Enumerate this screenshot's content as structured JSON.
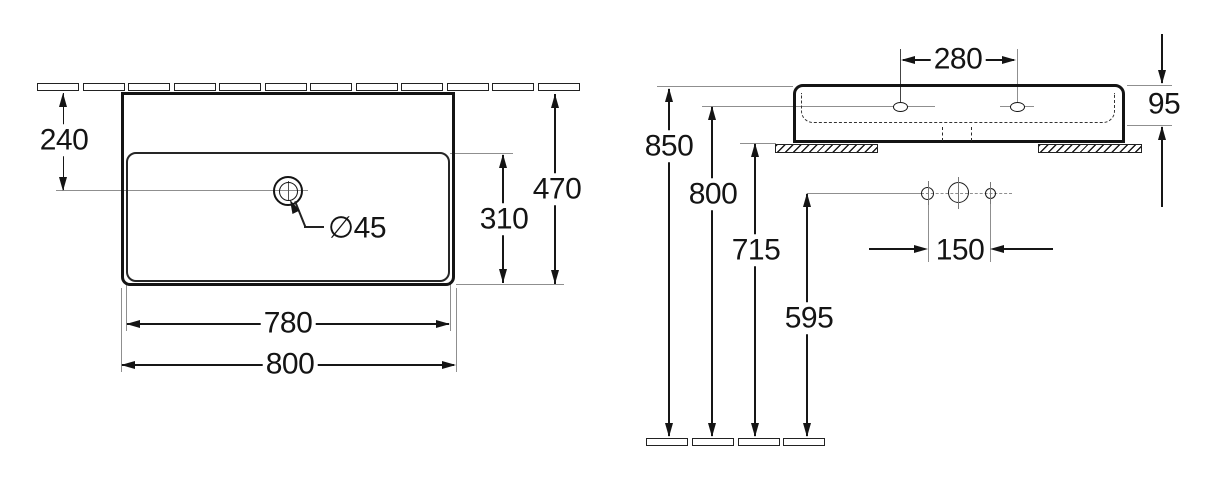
{
  "drawing_type": "washbasin installation dimensions, top view and side view",
  "left_view": {
    "dim_setback": "240",
    "dim_depth": "470",
    "dim_bowl_depth": "310",
    "dim_bowl_width": "780",
    "dim_width": "800",
    "dim_drain": "∅45"
  },
  "right_view": {
    "dim_tap_spacing": "280",
    "dim_body_height": "95",
    "dim_rim_height": "850",
    "dim_tap_height": "800",
    "dim_underside_height": "715",
    "dim_fixing_height": "595",
    "dim_fixing_spacing": "150"
  },
  "decor": {
    "wall_tile_count": 12,
    "floor_tile_count": 4,
    "line_color": "#161616",
    "thin_line_color": "#8f8f8f",
    "background": "#ffffff"
  }
}
